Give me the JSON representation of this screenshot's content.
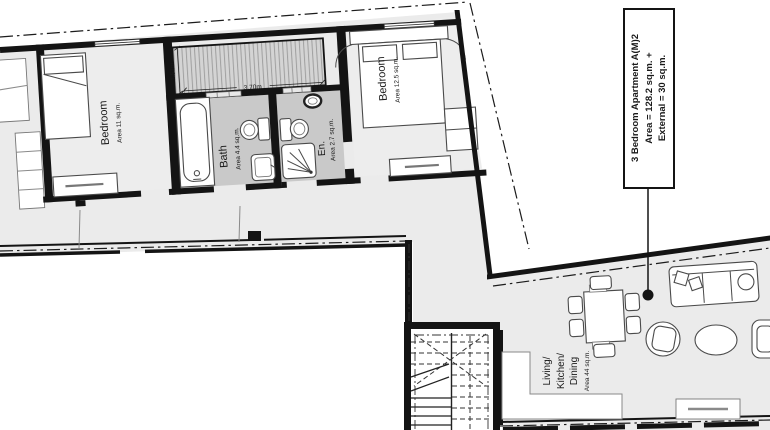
{
  "title_label": {
    "line1": "3 Bedroom Apartment  A(M)2",
    "line2": "Area = 128.2 sq.m. +",
    "line3": "External = 30 sq.m."
  },
  "rooms": {
    "bedroom1": {
      "name": "Bedroom",
      "area": "Area 11 sq.m."
    },
    "bath": {
      "name": "Bath",
      "area": "Area 4.4 sq.m."
    },
    "ensuite": {
      "name": "En.",
      "area": "Area 2.7 sq.m."
    },
    "bedroom2": {
      "name": "Bedroom",
      "area": "Area 12.5 sq.m."
    },
    "living": {
      "name_line1": "Living/",
      "name_line2": "Kitchen/",
      "name_line3": "Dining",
      "area": "Area 44 sq.m."
    }
  },
  "dimensions": {
    "terrace_depth": "1.51m",
    "terrace_width": "3.70m"
  },
  "colors": {
    "wall": "#141414",
    "floor": "#ededed",
    "wet": "#c9c9c9",
    "apartment": "#ebebeb",
    "hatch_fill": "#d4d4d4",
    "hatch_line": "#9f9f9f"
  }
}
